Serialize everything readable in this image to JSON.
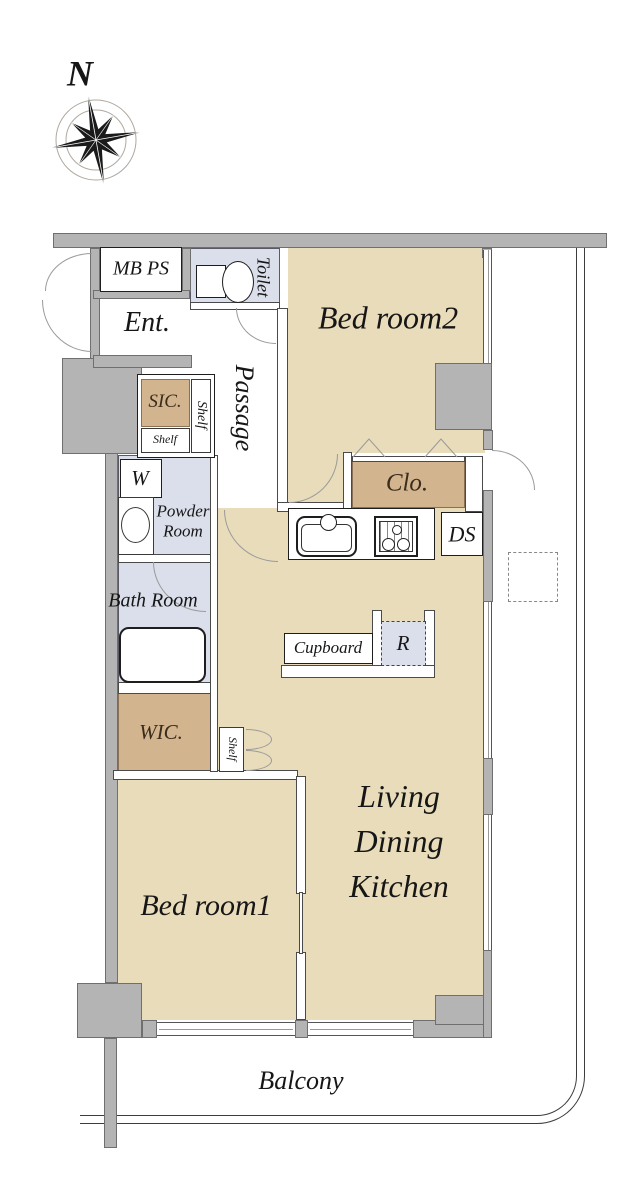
{
  "compass": {
    "north_label": "N"
  },
  "labels": {
    "mb_ps": "MB PS",
    "entrance": "Ent.",
    "toilet": "Toilet",
    "bedroom2": "Bed room2",
    "sic": "SIC.",
    "sic_shelf_side": "Shelf",
    "sic_shelf_bottom": "Shelf",
    "passage": "Passage",
    "washer": "W",
    "powder_room": "Powder Room",
    "bath_room": "Bath Room",
    "closet": "Clo.",
    "duct_space": "DS",
    "cupboard": "Cupboard",
    "refrigerator": "R",
    "wic": "WIC.",
    "bedroom_shelf": "Shelf",
    "bedroom1": "Bed room1",
    "ldk": "Living Dining Kitchen",
    "balcony": "Balcony"
  },
  "colors": {
    "room_tan": "#e9dcba",
    "closet_tan": "#d2b48e",
    "wet_room_blue": "#dbdfeb",
    "wall_gray": "#b4b4b4",
    "line_dark": "#1e1e1e"
  }
}
